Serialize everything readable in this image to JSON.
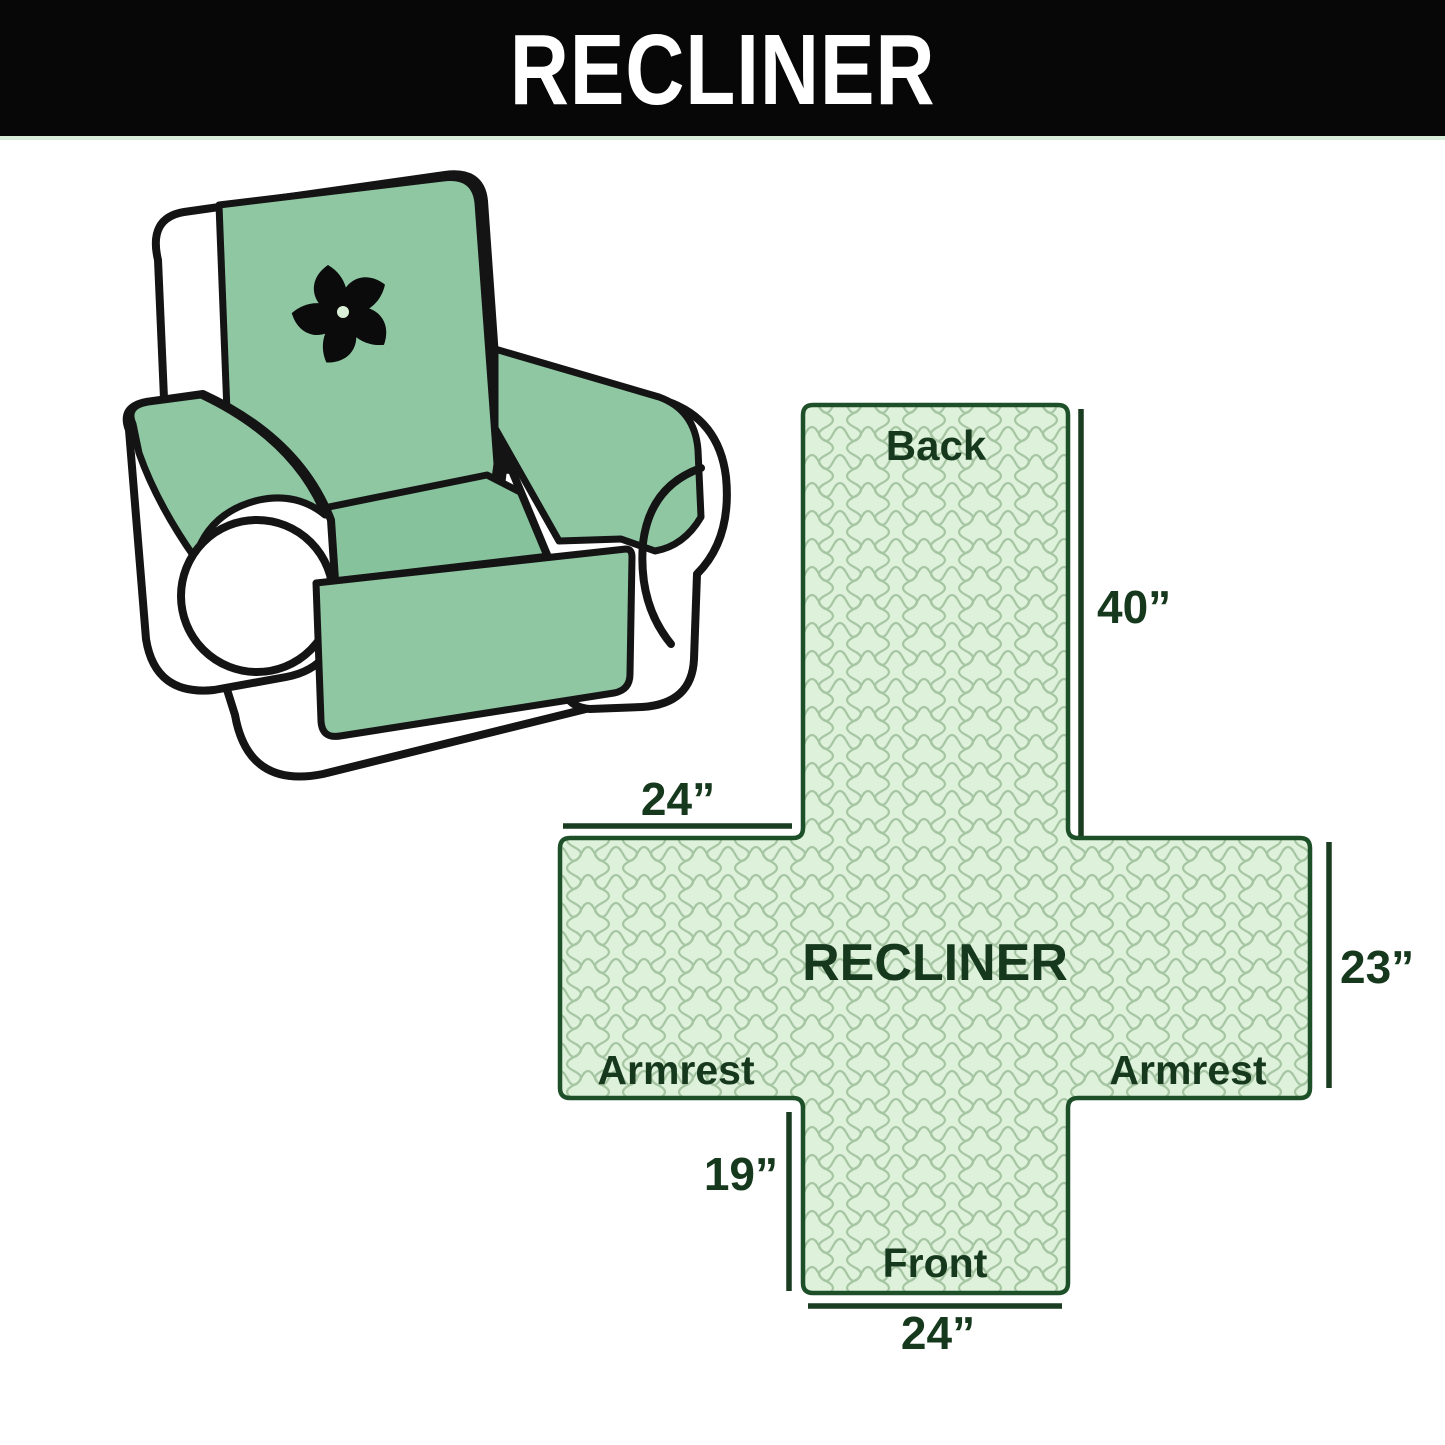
{
  "header": {
    "title": "RECLINER",
    "background_color": "#070707",
    "text_color": "#ffffff"
  },
  "chair_illustration": {
    "description": "armchair recliner with mint protective cover",
    "cover_color": "#8fc7a3",
    "outline_color": "#141414",
    "logo_icon": "pinwheel-fan-icon",
    "logo_color": "#0b0b0b"
  },
  "pattern_diagram": {
    "center_label": "RECLINER",
    "sections": {
      "back": "Back",
      "front": "Front",
      "armrest_left": "Armrest",
      "armrest_right": "Armrest"
    },
    "dimensions": {
      "back_length": "40”",
      "top_width": "24”",
      "side_depth": "23”",
      "front_drop": "19”",
      "front_width": "24”"
    },
    "colors": {
      "fill": "#def1da",
      "texture": "#a6c5a2",
      "outline": "#1d4f28",
      "label": "#16391d",
      "dimension_line": "#1a3c20"
    }
  }
}
